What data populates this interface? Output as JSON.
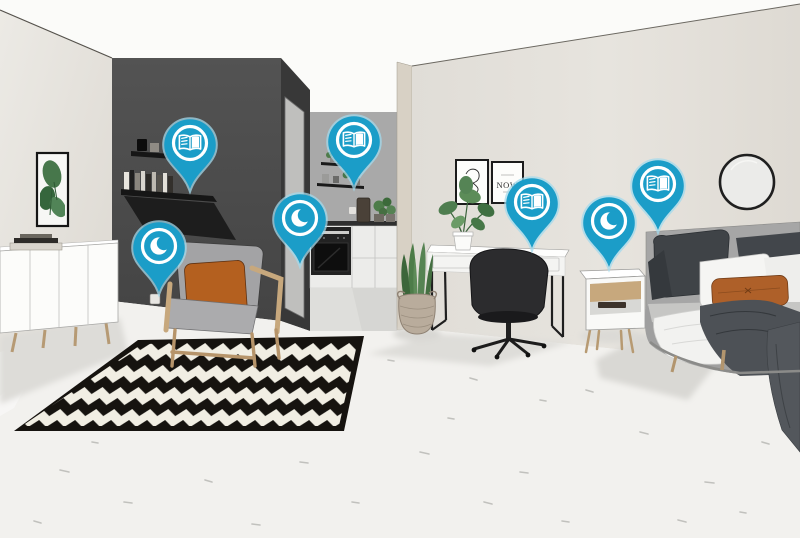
{
  "colors": {
    "pin_blue": "#1b9dc8",
    "pin_halo": "#a3d9ec",
    "pin_icon": "#ffffff",
    "wall_light": "#e4e1db",
    "wall_dark": "#4b4b4b",
    "wall_kitchen": "#a9a9a9",
    "floor": "#f2f1ee",
    "rug_black": "#16130f",
    "rug_cream": "#f1eee3",
    "accent_orange": "#b2622a",
    "wood": "#b89a72",
    "chair_black": "#2c2c2e",
    "plant_green": "#4e7d4f"
  },
  "poster": {
    "now_text": "NOW"
  },
  "pins": [
    {
      "id": "pin-wall-shelf",
      "icon": "open-book-icon",
      "x": 190,
      "y": 143
    },
    {
      "id": "pin-armchair",
      "icon": "moon-icon",
      "x": 159,
      "y": 246
    },
    {
      "id": "pin-kitchen-shelf",
      "icon": "open-book-icon",
      "x": 354,
      "y": 140
    },
    {
      "id": "pin-kitchen-counter",
      "icon": "moon-icon",
      "x": 300,
      "y": 218
    },
    {
      "id": "pin-desk",
      "icon": "open-book-icon",
      "x": 532,
      "y": 202
    },
    {
      "id": "pin-nightstand",
      "icon": "moon-icon",
      "x": 609,
      "y": 221
    },
    {
      "id": "pin-bed",
      "icon": "open-book-icon",
      "x": 658,
      "y": 184
    }
  ]
}
